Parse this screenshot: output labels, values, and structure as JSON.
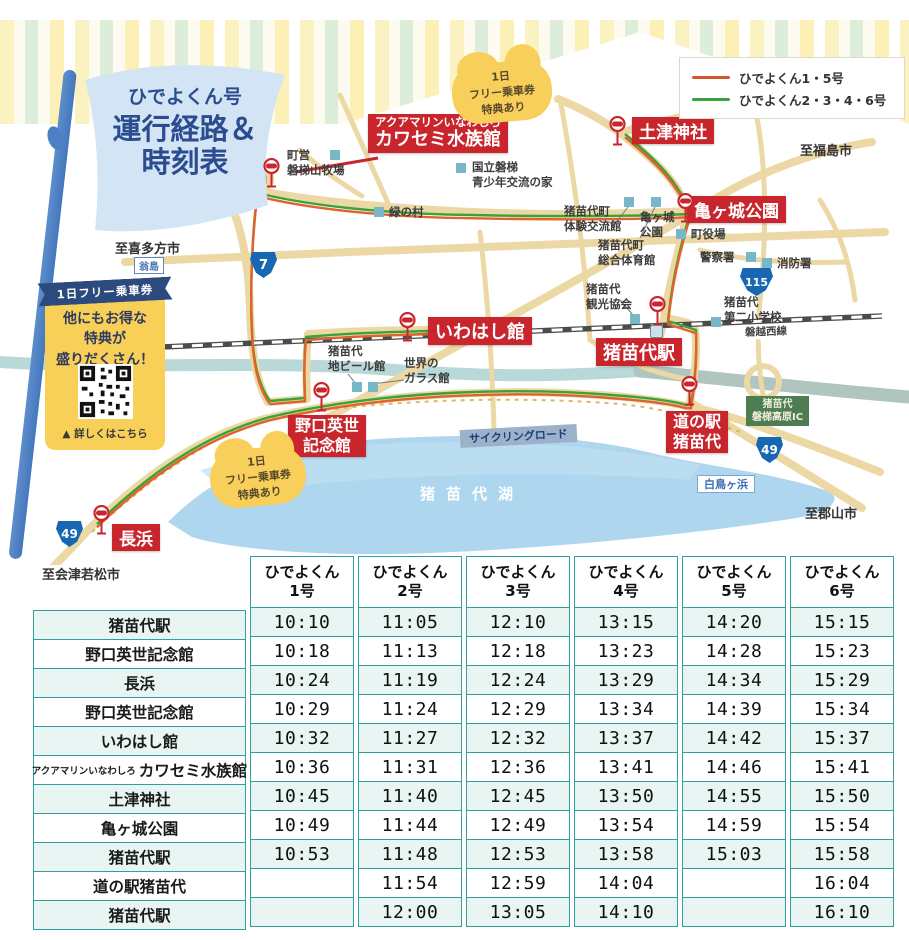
{
  "title": {
    "l1": "ひでよくん号",
    "l2": "運行経路＆",
    "l3": "時刻表"
  },
  "legend": {
    "items": [
      {
        "label": "ひでよくん1・5号",
        "color": "#d4572c"
      },
      {
        "label": "ひでよくん2・3・4・6号",
        "color": "#3aa23a"
      }
    ]
  },
  "promo": {
    "ribbon": "1日フリー乗車券",
    "l1": "他にもお得な",
    "l2": "特典が",
    "l3": "盛りだくさん！",
    "cta": "▲ 詳しくはこちら"
  },
  "cloud": {
    "l1": "1日",
    "l2": "フリー乗車券",
    "l3": "特典あり"
  },
  "map": {
    "stop_labels": {
      "aquarium": {
        "small": "アクアマリンいなわしろ",
        "large": "カワセミ水族館"
      },
      "hanitsu": "土津神社",
      "kamegajo": "亀ヶ城公園",
      "iwahashi": "いわはし館",
      "station": "猪苗代駅",
      "noguchi": {
        "l1": "野口英世",
        "l2": "記念館"
      },
      "michinoeki": {
        "l1": "道の駅",
        "l2": "猪苗代"
      },
      "nagahama": "長浜"
    },
    "places": {
      "bokujo": {
        "l1": "町営",
        "l2": "磐梯山牧場"
      },
      "kokuritsu": {
        "l1": "国立磐梯",
        "l2": "青少年交流の家"
      },
      "midorinomura": "緑の村",
      "taiken": {
        "l1": "猪苗代町",
        "l2": "体験交流館"
      },
      "taiikukan": {
        "l1": "猪苗代町",
        "l2": "総合体育館"
      },
      "kamegajo_small": {
        "l1": "亀ヶ城",
        "l2": "公園"
      },
      "yakuba": "町役場",
      "keisatsu": "警察署",
      "shobo": "消防署",
      "kanko": {
        "l1": "猪苗代",
        "l2": "観光協会"
      },
      "shogakko": {
        "l1": "猪苗代",
        "l2": "第二小学校"
      },
      "jibeer": {
        "l1": "猪苗代",
        "l2": "地ビール館"
      },
      "glass": {
        "l1": "世界の",
        "l2": "ガラス館"
      }
    },
    "directions": {
      "fukushima": "至福島市",
      "kitakata": "至喜多方市",
      "aizu": "至会津若松市",
      "koriyama": "至郡山市"
    },
    "labels": {
      "lake": "猪苗代湖",
      "railway": "磐越西線",
      "cycling": "サイクリングロード",
      "beach": "白鳥ヶ浜",
      "okinashima": "翁島",
      "ic1": "猪苗代",
      "ic2": "磐梯高原IC"
    },
    "shields": {
      "r7": "7",
      "r115": "115",
      "r49": "49"
    }
  },
  "timetable": {
    "columns": [
      {
        "l1": "ひでよくん",
        "l2": "1号"
      },
      {
        "l1": "ひでよくん",
        "l2": "2号"
      },
      {
        "l1": "ひでよくん",
        "l2": "3号"
      },
      {
        "l1": "ひでよくん",
        "l2": "4号"
      },
      {
        "l1": "ひでよくん",
        "l2": "5号"
      },
      {
        "l1": "ひでよくん",
        "l2": "6号"
      }
    ],
    "rows": [
      {
        "name": "猪苗代駅",
        "times": [
          "10:10",
          "11:05",
          "12:10",
          "13:15",
          "14:20",
          "15:15"
        ]
      },
      {
        "name": "野口英世記念館",
        "times": [
          "10:18",
          "11:13",
          "12:18",
          "13:23",
          "14:28",
          "15:23"
        ]
      },
      {
        "name": "長浜",
        "times": [
          "10:24",
          "11:19",
          "12:24",
          "13:29",
          "14:34",
          "15:29"
        ]
      },
      {
        "name": "野口英世記念館",
        "times": [
          "10:29",
          "11:24",
          "12:29",
          "13:34",
          "14:39",
          "15:34"
        ]
      },
      {
        "name": "いわはし館",
        "times": [
          "10:32",
          "11:27",
          "12:32",
          "13:37",
          "14:42",
          "15:37"
        ]
      },
      {
        "prefix": "アクアマリンいなわしろ",
        "name": "カワセミ水族館",
        "times": [
          "10:36",
          "11:31",
          "12:36",
          "13:41",
          "14:46",
          "15:41"
        ]
      },
      {
        "name": "土津神社",
        "times": [
          "10:45",
          "11:40",
          "12:45",
          "13:50",
          "14:55",
          "15:50"
        ]
      },
      {
        "name": "亀ヶ城公園",
        "times": [
          "10:49",
          "11:44",
          "12:49",
          "13:54",
          "14:59",
          "15:54"
        ]
      },
      {
        "name": "猪苗代駅",
        "times": [
          "10:53",
          "11:48",
          "12:53",
          "13:58",
          "15:03",
          "15:58"
        ]
      },
      {
        "name": "道の駅猪苗代",
        "times": [
          "",
          "11:54",
          "12:59",
          "14:04",
          "",
          "16:04"
        ]
      },
      {
        "name": "猪苗代駅",
        "times": [
          "",
          "12:00",
          "13:05",
          "14:10",
          "",
          "16:10"
        ]
      }
    ]
  }
}
